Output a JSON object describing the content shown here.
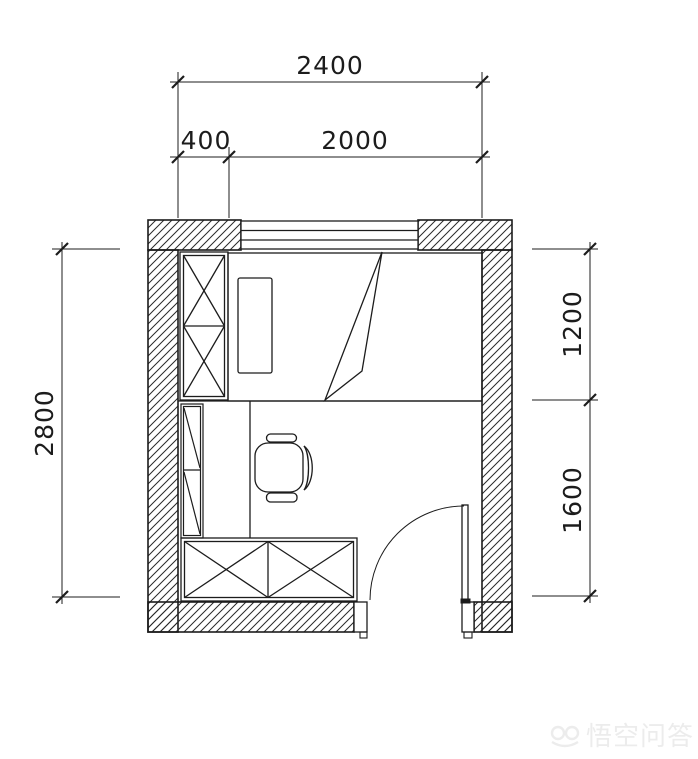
{
  "canvas": {
    "width": 698,
    "height": 759,
    "background": "#ffffff",
    "line_color": "#1c1c1c"
  },
  "floor_plan": {
    "type": "bedroom-plan",
    "dimensions": {
      "top_total": "2400",
      "top_segment_left": "400",
      "top_segment_right": "2000",
      "left_total": "2800",
      "right_upper": "1200",
      "right_lower": "1600"
    },
    "symbols": [
      "wall-hatch",
      "window",
      "wardrobe",
      "bed",
      "pillow",
      "blanket-fold",
      "desk",
      "office-chair",
      "bookshelf",
      "low-cabinet",
      "door-swing"
    ]
  },
  "watermark": {
    "logo": "wukong-monkey-logo",
    "text": "悟空问答",
    "color": "#ececec"
  }
}
